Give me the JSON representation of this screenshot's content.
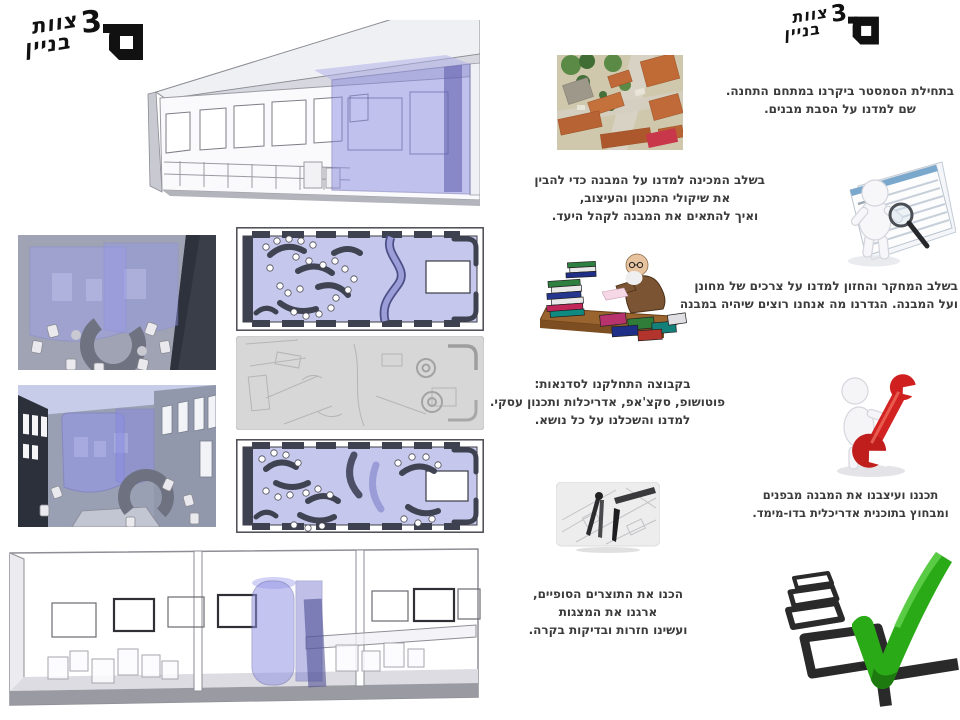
{
  "logo": {
    "word_top": "צוות",
    "digit": "3",
    "word_bottom": "בניין"
  },
  "left_panel": {
    "images": [
      {
        "name": "exterior-render"
      },
      {
        "name": "interior-render-1"
      },
      {
        "name": "interior-render-2"
      },
      {
        "name": "floor-plan-color-1"
      },
      {
        "name": "floor-plan-sketch"
      },
      {
        "name": "floor-plan-color-2"
      },
      {
        "name": "long-section-render"
      }
    ]
  },
  "steps": [
    {
      "name": "site-visit",
      "icon": "aerial-photo-icon",
      "lines": [
        "בתחילת הסמסטר ביקרנו במתחם התחנה.",
        "שם למדנו על הסבת מבנים."
      ]
    },
    {
      "name": "prep-stage",
      "icon": "inspection-figure-icon",
      "lines": [
        "בשלב המכינה למדנו על המבנה כדי להבין",
        "את שיקולי התכנון והעיצוב,",
        "ואיך להתאים את המבנה לקהל היעד."
      ]
    },
    {
      "name": "research-stage",
      "icon": "professor-books-icon",
      "lines": [
        "בשלב המחקר והחזון למדנו על צרכים של מחונן",
        "ועל המבנה.  הגדרנו מה אנחנו רוצים שיהיה במבנה"
      ]
    },
    {
      "name": "workshops",
      "icon": "wrench-figure-icon",
      "lines": [
        "בקבוצה התחלקנו לסדנאות:",
        "פוטושופ, סקצ'אפ, אדריכלות ותכנון עסקי.",
        "למדנו והשכלנו על כל  נושא."
      ]
    },
    {
      "name": "design-stage",
      "icon": "drafting-tools-icon",
      "lines": [
        "תכננו ועיצבנו את המבנה מבפנים",
        "ומבחוץ בתוכנית אדריכלית בדו-מימד."
      ]
    },
    {
      "name": "final-products",
      "icon": "green-checkmark-icon",
      "lines": [
        "הכנו את התוצרים הסופיים,",
        "ארגנו את המצגות",
        "ועשינו חזרות ובדיקות בקרה."
      ]
    }
  ],
  "colors": {
    "accent_purple": "#8c8ce0",
    "check_green": "#2baa17",
    "wrench_red": "#cf1f1f",
    "text": "#3b3b3b"
  }
}
